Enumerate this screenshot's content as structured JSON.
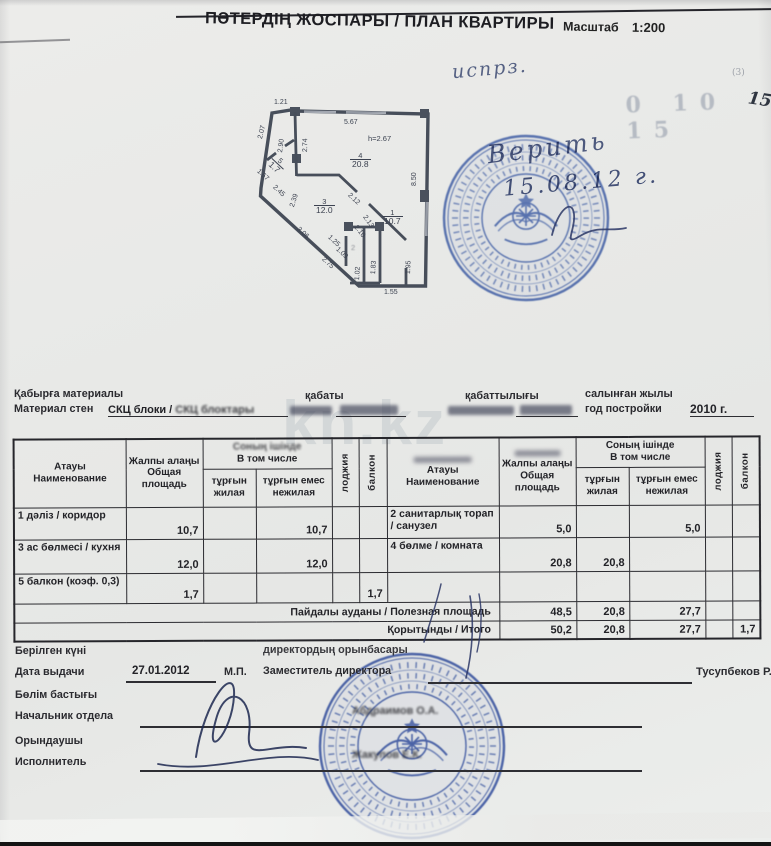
{
  "header": {
    "title": "ПӘТЕРДІҢ ЖОСПАРЫ / ПЛАН КВАРТИРЫ",
    "scale_label": "Масштаб",
    "scale_value": "1:200"
  },
  "handwriting": {
    "note_top": "испрз.",
    "verify": "Верить",
    "date": "15.08.12 г.",
    "corner_faint": "0 10 15",
    "corner_number": "15",
    "corner_tiny": "(3)"
  },
  "watermark": "kn.kz",
  "plan": {
    "height_label": "h=2.67",
    "rooms": [
      {
        "n": "1",
        "a": "10.7"
      },
      {
        "n": "2",
        "a": ""
      },
      {
        "n": "3",
        "a": "12.0"
      },
      {
        "n": "4",
        "a": "20.8"
      },
      {
        "n": "5",
        "a": "1.7"
      }
    ],
    "dims": {
      "d121": "1.21",
      "d207": "2.07",
      "d290": "2.90",
      "d274": "2.74",
      "d567": "5.67",
      "d850": "8.50",
      "d167": "1.67",
      "d245": "2.45",
      "d239": "2.39",
      "d306": "3.06",
      "d212": "2.12",
      "d125": "1.25",
      "d109": "1.09",
      "d213": "2.13",
      "d210": "2.10",
      "d275": "2.75",
      "d102": "1.02",
      "d183": "1.83",
      "d155": "1.55",
      "d195": "1.95"
    }
  },
  "form": {
    "wall_label_kz": "Қабырға материалы",
    "wall_label_ru": "Материал стен",
    "wall_value_clear": "СКЦ блоки /",
    "wall_value_blur": " СКЦ блоктары",
    "floor_label_kz": "қабаты",
    "storeys_label_kz": "қабаттылығы",
    "year_label_kz": "салынған жылы",
    "year_label_ru": "год постройки",
    "year_value": "2010 г."
  },
  "table": {
    "header": {
      "name_kz": "Атауы",
      "name_ru": "Наименование",
      "total_kz": "Жалпы алаңы",
      "total_ru": "Общая площадь",
      "incl_kz": "Соның ішінде",
      "incl_ru": "В том числе",
      "living_kz": "тұрғын",
      "living_ru": "жилая",
      "nonliving_kz": "тұрғын емес",
      "nonliving_ru": "нежилая",
      "loggia": "лоджия",
      "balcony": "балкон"
    },
    "left_rows": [
      {
        "name": "1 дәліз / коридор",
        "total": "10,7",
        "living": "",
        "nonliving": "10,7",
        "loggia": "",
        "balcony": ""
      },
      {
        "name": "3 ас бөлмесі / кухня",
        "total": "12,0",
        "living": "",
        "nonliving": "12,0",
        "loggia": "",
        "balcony": ""
      },
      {
        "name": "5 балкон (коэф. 0,3)",
        "total": "1,7",
        "living": "",
        "nonliving": "",
        "loggia": "",
        "balcony": "1,7"
      }
    ],
    "right_rows": [
      {
        "name": "2 санитарлық торап / санузел",
        "total": "5,0",
        "living": "",
        "nonliving": "5,0",
        "loggia": "",
        "balcony": ""
      },
      {
        "name": "4 бөлме / комната",
        "total": "20,8",
        "living": "20,8",
        "nonliving": "",
        "loggia": "",
        "balcony": ""
      },
      {
        "name": "",
        "total": "",
        "living": "",
        "nonliving": "",
        "loggia": "",
        "balcony": ""
      }
    ],
    "totals": [
      {
        "label": "Пайдалы ауданы / Полезная площадь",
        "total": "48,5",
        "living": "20,8",
        "nonliving": "27,7",
        "loggia": "",
        "balcony": ""
      },
      {
        "label": "Қорытынды / Итого",
        "total": "50,2",
        "living": "20,8",
        "nonliving": "27,7",
        "loggia": "",
        "balcony": "1,7"
      }
    ]
  },
  "footer": {
    "issued_kz": "Берілген күні",
    "issued_ru": "Дата выдачи",
    "issued_value": "27.01.2012",
    "mp": "М.П.",
    "deputy_kz": "директордың орынбасары",
    "deputy_ru": "Заместитель директора",
    "deputy_name": "Тусупбеков Р.Р.",
    "head_kz": "Бөлім бастығы",
    "head_ru": "Начальник отдела",
    "head_name": "Абдраимов О.А.",
    "executor_kz": "Орындаушы",
    "executor_ru": "Исполнитель",
    "executor_name": "Жакупов Е.К."
  }
}
